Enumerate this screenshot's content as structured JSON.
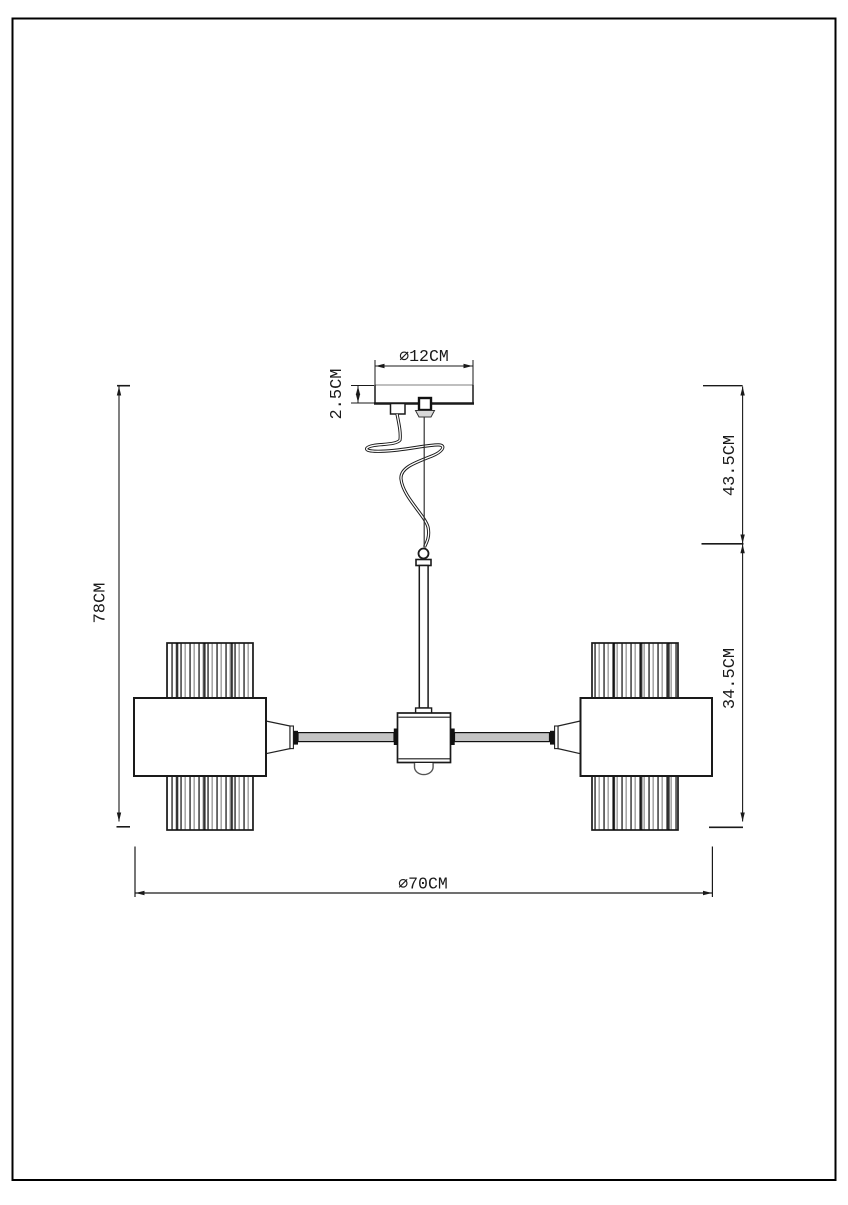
{
  "diagram": {
    "type": "lighting-fixture-dimension-drawing",
    "dimensions": {
      "canopy_diameter": "⌀12CM",
      "canopy_height": "2.5CM",
      "overall_height": "78CM",
      "suspension_length": "43.5CM",
      "fixture_height": "34.5CM",
      "overall_diameter": "⌀70CM"
    },
    "colors": {
      "line": "#1a1a1a",
      "secondary": "#808080",
      "background": "#ffffff"
    }
  }
}
